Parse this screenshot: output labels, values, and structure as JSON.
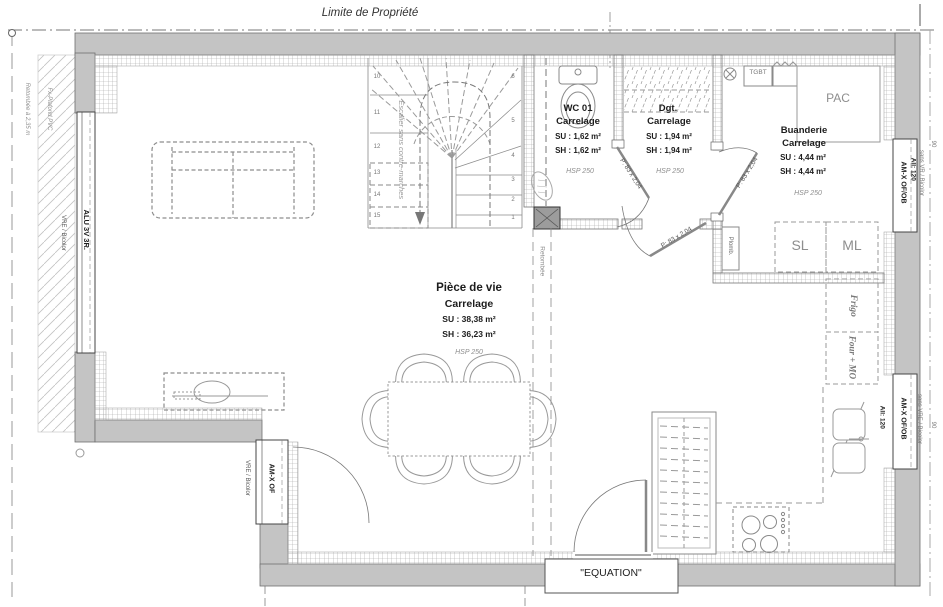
{
  "property_line_label": "Limite de Propriété",
  "rooms": {
    "wc": {
      "name": "WC 01",
      "finish": "Carrelage",
      "su": "SU : 1,62 m²",
      "sh": "SH : 1,62 m²",
      "hsp": "HSP 250"
    },
    "dgt": {
      "name": "Dgt.",
      "finish": "Carrelage",
      "su": "SU : 1,94 m²",
      "sh": "SH : 1,94 m²",
      "hsp": "HSP 250"
    },
    "buanderie": {
      "name": "Buanderie",
      "finish": "Carrelage",
      "su": "SU : 4,44 m²",
      "sh": "SH : 4,44 m²",
      "hsp": "HSP 250"
    },
    "piece_de_vie": {
      "name": "Pièce de vie",
      "finish": "Carrelage",
      "su": "SU : 38,38 m²",
      "sh": "SH : 36,23 m²",
      "hsp": "HSP 250"
    }
  },
  "equipment": {
    "pac": "PAC",
    "tgbt": "TGBT",
    "sl": "SL",
    "ml": "ML",
    "frigo": "Frigo",
    "four_mo": "Four + MO",
    "plomb": "Plomb."
  },
  "stairs": {
    "label": "Escalier sans contre-marches",
    "left_steps": [
      "10",
      "11",
      "12",
      "13",
      "14",
      "15"
    ],
    "right_steps": [
      "6",
      "5",
      "4",
      "3",
      "2",
      "1"
    ]
  },
  "doors": {
    "leaf_label": "P: 83 x 2,04"
  },
  "windows": {
    "left": {
      "type": "ALU 3V 3R.",
      "finish": "VRE / Bicolor"
    },
    "bottom_left": {
      "type": "AM-X OF",
      "finish": "VRE / Bicolor"
    },
    "right_top": {
      "type": "AM-X OF/OB",
      "sill": "All: 120",
      "finish": "sans VR / Bicolor",
      "dim": "90"
    },
    "right_bottom": {
      "type": "AM-X OF/OB",
      "sill": "All: 120",
      "finish": "sans VRE / Bicolor",
      "dim": "90"
    }
  },
  "annotations": {
    "retombee_left": "Retombée à 2,35 m",
    "fx_plafond": "Fx-Plafond PVC",
    "retombee_center": "Retombée",
    "entry_label": "\"EQUATION\""
  }
}
